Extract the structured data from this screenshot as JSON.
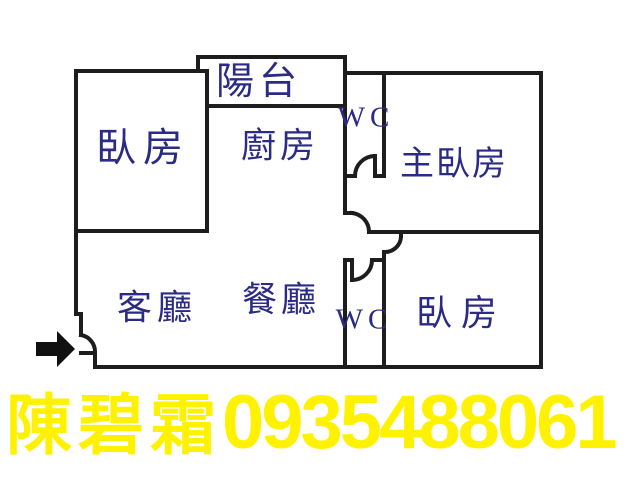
{
  "page": {
    "background": "#ffffff",
    "type": "real-estate floor plan flyer"
  },
  "floorplan": {
    "colors": {
      "wall": "#1d1d1d",
      "room_label": "#2b2b85"
    },
    "rooms": {
      "balcony": {
        "label": "陽台"
      },
      "bedroom_left": {
        "label": "臥房"
      },
      "kitchen": {
        "label": "廚房"
      },
      "wc_upper": {
        "label": "WC"
      },
      "master_bedroom": {
        "label": "主臥房"
      },
      "living_room": {
        "label": "客廳"
      },
      "dining_room": {
        "label": "餐廳"
      },
      "wc_lower": {
        "label": "WC"
      },
      "bedroom_right": {
        "label": "臥房"
      }
    },
    "entrance": {
      "icon": "entrance-arrow-icon",
      "color": "#111111"
    }
  },
  "banner": {
    "agent_name": "陳碧霜",
    "phone_number": "0935488061",
    "color": "#fff200"
  }
}
